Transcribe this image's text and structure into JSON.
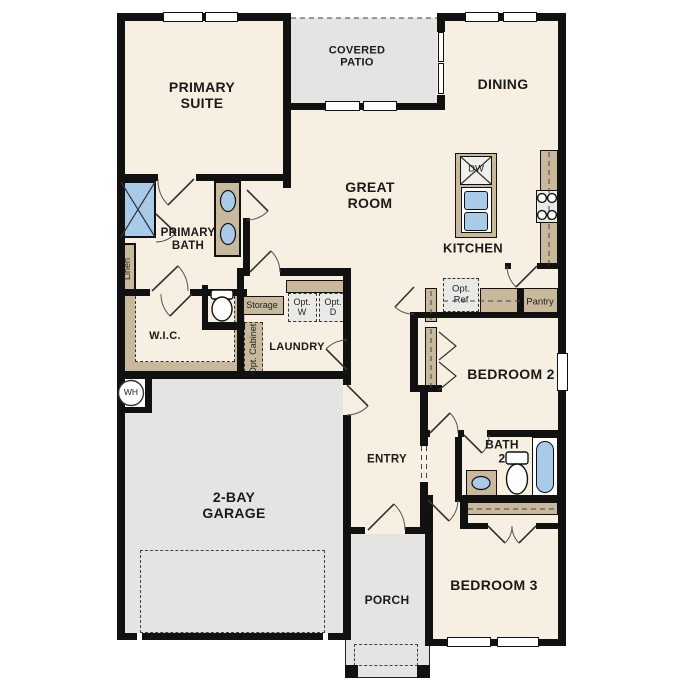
{
  "title": "Single-story house floor plan",
  "colors": {
    "wall": "#111111",
    "floor": "#f7efe1",
    "concrete": "#e5e4e2",
    "cabinet": "#c8b99c",
    "fixture_blue": "#a9cbe9",
    "option_box": "#e9e9e6",
    "text": "#1a1a1a"
  },
  "labels": {
    "primary_suite": "PRIMARY\nSUITE",
    "covered_patio": "COVERED\nPATIO",
    "dining": "DINING",
    "great_room": "GREAT\nROOM",
    "kitchen": "KITCHEN",
    "primary_bath": "PRIMARY\nBATH",
    "wic": "W.I.C.",
    "laundry": "LAUNDRY",
    "entry": "ENTRY",
    "garage": "2-BAY\nGARAGE",
    "porch": "PORCH",
    "bedroom2": "BEDROOM 2",
    "bath2": "BATH\n2",
    "bedroom3": "BEDROOM 3",
    "linen": "Linen",
    "storage": "Storage",
    "opt_cabinet": "Opt. Cabinet",
    "opt_w": "Opt.\nW",
    "opt_d": "Opt.\nD",
    "opt_ref": "Opt.\nRef",
    "pantry": "Pantry",
    "dw": "DW",
    "wh": "WH"
  }
}
